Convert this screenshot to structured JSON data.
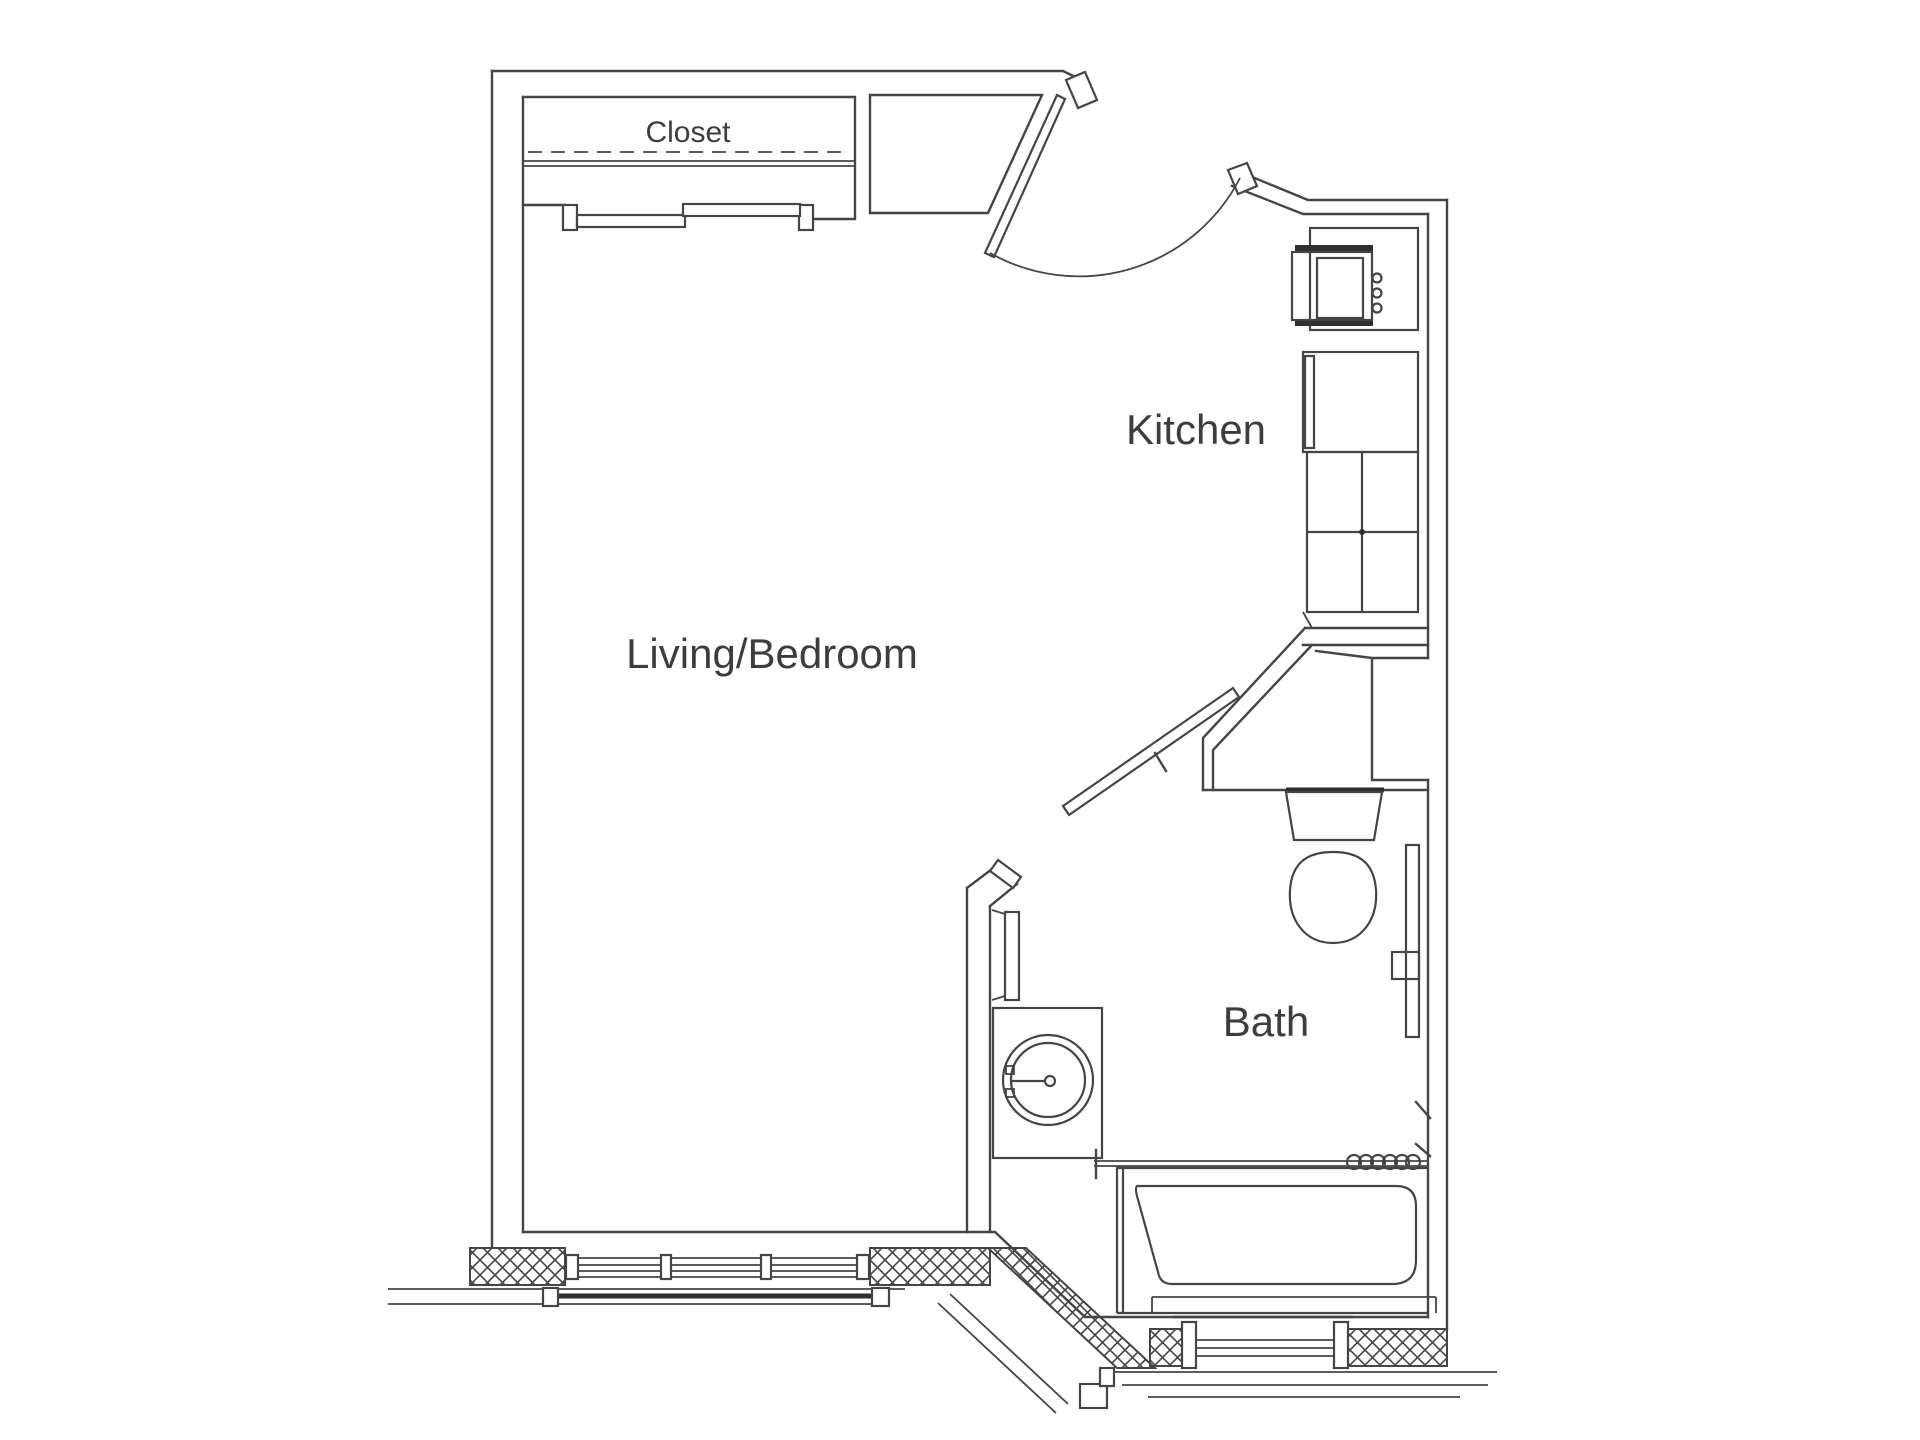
{
  "page": {
    "background_color": "#ffffff",
    "line_color": "#454545",
    "text_color": "#3d3d3d",
    "type": "architectural floor plan, studio apartment"
  },
  "floorplan": {
    "rooms": {
      "closet": {
        "label": "Closet"
      },
      "kitchen": {
        "label": "Kitchen"
      },
      "living_bedroom": {
        "label": "Living/Bedroom"
      },
      "bath": {
        "label": "Bath"
      }
    },
    "features": [
      {
        "name": "entry-door",
        "type": "hinged door with swing arc, angled wall"
      },
      {
        "name": "closet-sliding-doors",
        "type": "bypass sliding doors with dashed rod line and shelf line"
      },
      {
        "name": "entry-shelf-nook",
        "type": "trapezoidal nook beside closet"
      },
      {
        "name": "stove",
        "type": "range with 3 control knobs"
      },
      {
        "name": "refrigerator",
        "type": "refrigerator with door line"
      },
      {
        "name": "kitchen-counter",
        "type": "base cabinets 2x2 grid with sink dot"
      },
      {
        "name": "bath-pocket-door",
        "type": "angled sliding door"
      },
      {
        "name": "wall-niche",
        "type": "recessed niche beside bath entry"
      },
      {
        "name": "toilet",
        "type": "tank and elongated bowl"
      },
      {
        "name": "bathroom-vanity-sink",
        "type": "round basin with faucet"
      },
      {
        "name": "towel-bar-left",
        "type": "towel bar on bath partition wall"
      },
      {
        "name": "grab-bar-right",
        "type": "vertical bar on right wall"
      },
      {
        "name": "toilet-paper-holder",
        "type": "square dispenser on right wall"
      },
      {
        "name": "bathtub",
        "type": "tub with apron"
      },
      {
        "name": "shower-curtain-rod",
        "type": "rod with 6 curtain rings"
      },
      {
        "name": "living-room-window",
        "type": "3-pane window in hatched exterior wall"
      },
      {
        "name": "bath-window",
        "type": "single window in hatched exterior wall"
      },
      {
        "name": "bay-angled-wall",
        "type": "diagonal hatched exterior wall segment"
      }
    ]
  }
}
